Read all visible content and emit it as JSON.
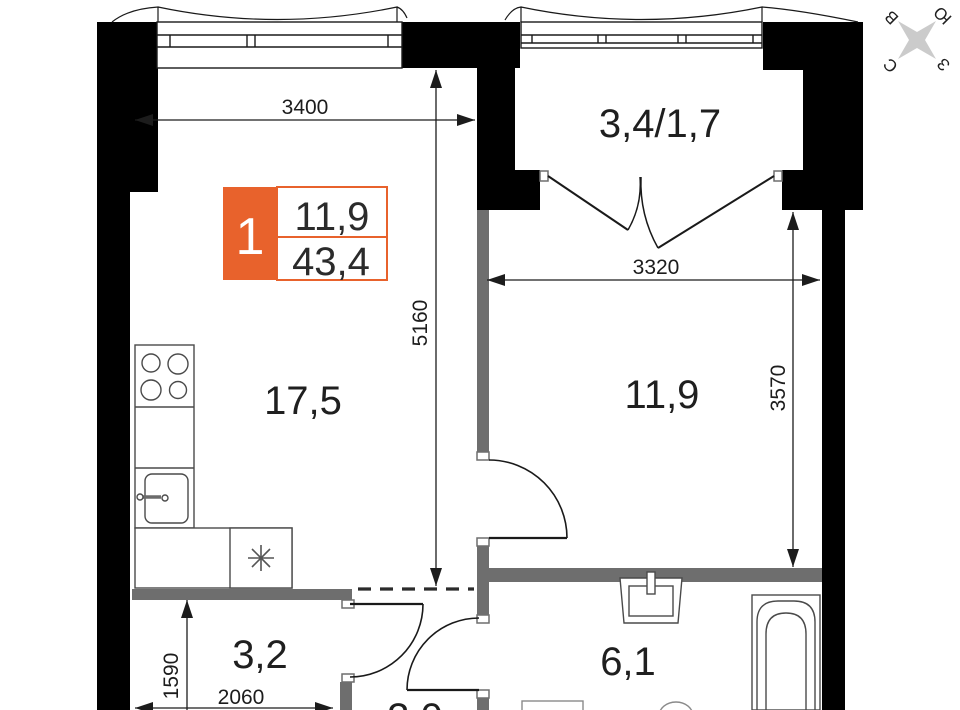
{
  "colors": {
    "accent_orange": "#E8622C",
    "wall_black": "#000000",
    "wall_gray": "#6E6E6E",
    "line_dark": "#1C1C1C",
    "fixture_gray": "#4A4A4A",
    "compass_gray": "#CBCBCB",
    "text_dark": "#1F1F1F"
  },
  "unit_badge": {
    "number": "1",
    "room_area": "11,9",
    "total_area": "43,4"
  },
  "room_labels": {
    "kitchen_living": "17,5",
    "bedroom": "11,9",
    "balcony": "3,4/1,7",
    "hallway": "3,2",
    "bathroom": "6,1",
    "wardrobe": "3,0"
  },
  "dimensions": {
    "kitchen_width": "3400",
    "kitchen_depth": "5160",
    "bedroom_width": "3320",
    "bedroom_depth": "3570",
    "hallway_depth": "1590",
    "hallway_width": "2060"
  },
  "compass": {
    "north": "С",
    "south": "Ю",
    "east": "В",
    "west": "З"
  },
  "icons": {
    "washer_symbol": "asterisk-8-spoke",
    "compass_symbol": "four-point-star"
  }
}
